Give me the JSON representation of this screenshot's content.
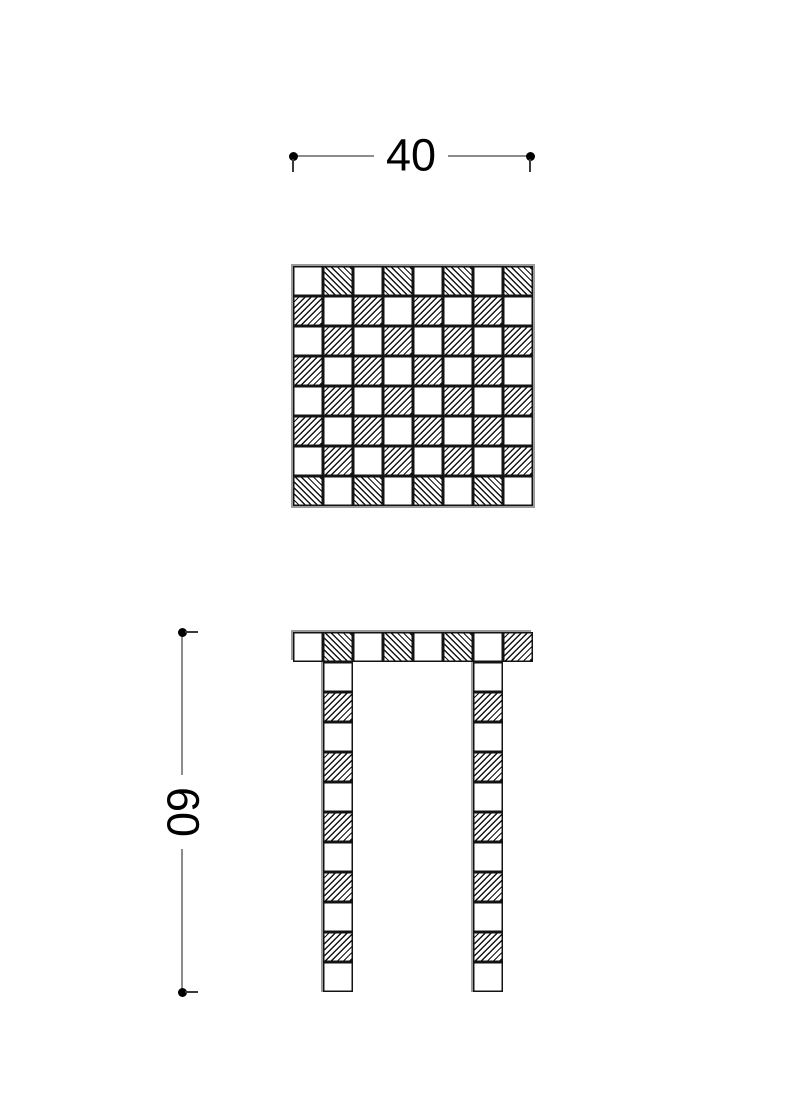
{
  "drawing": {
    "dim_width": {
      "label": "40"
    },
    "dim_height": {
      "label": "60"
    },
    "hatch_legend": {
      "w": "plain-white",
      "b": "hatch-diagonal-backslash",
      "f": "hatch-diagonal-forward"
    },
    "top_view": {
      "rows": 8,
      "cols": 8,
      "pattern": [
        "wbwbwbwb",
        "fwfwfwfw",
        "wfwfwfwf",
        "fwfwfwfw",
        "wfwfwfwf",
        "fwfwfwfw",
        "wfwfwfwf",
        "bwbwbwbw"
      ]
    },
    "front_view": {
      "seat_pattern": [
        "wbwbwbwf"
      ],
      "leg_pattern": [
        "wfwfwfwfwfw"
      ],
      "leg_count": 2
    },
    "colors": {
      "background": "#ffffff",
      "ink": "#131313",
      "dim_line": "#8c8c8c",
      "ghost_outline": "#9a9a9a",
      "text": "#000000"
    }
  }
}
